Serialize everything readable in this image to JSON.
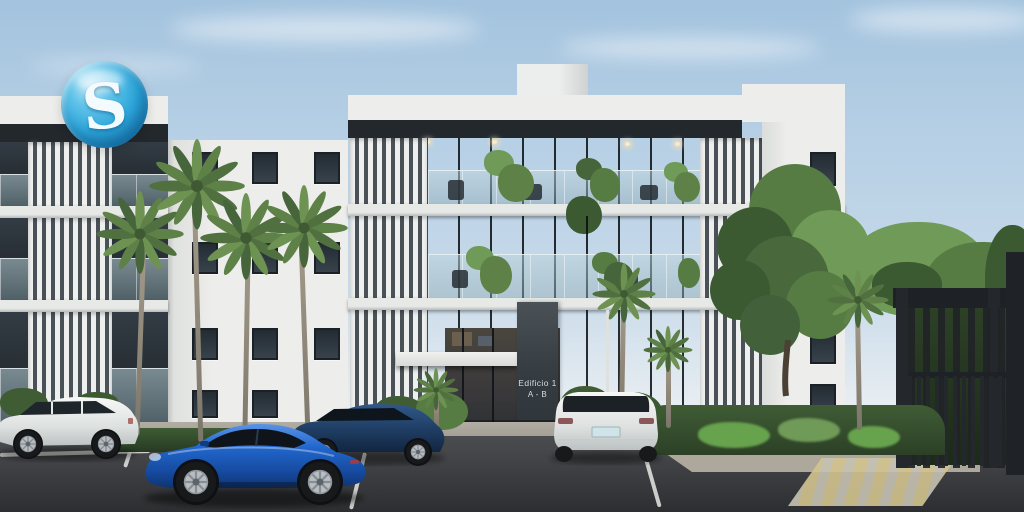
{
  "watermark": {
    "letter": "S",
    "icon": "glossy-blue-sphere-s-logo"
  },
  "signage": {
    "building_sign_line1": "Edificio 1",
    "building_sign_line2": "A - B"
  },
  "colors": {
    "sky_top": "#a3c3de",
    "sky_mid": "#c6d9e9",
    "sky_horizon": "#e9eef2",
    "cloud": "#ffffff",
    "facade_white": "#ededeb",
    "facade_shade": "#dadddb",
    "fascia_dark": "#23282d",
    "glass_dark": "#272e35",
    "balcony_glass": "#9db9c4",
    "louver_light": "#eef0f0",
    "louver_gap": "#4a5258",
    "slab_white": "#e7e9e7",
    "slab_shadow": "#b7bbba",
    "ceiling_light": "#ffe9c4",
    "palm_green": "#5e8148",
    "palm_green_dark": "#47653a",
    "palm_trunk": "#97907f",
    "tree_green": "#567c43",
    "tree_green_dark": "#3c5a31",
    "tree_green_light": "#6f9a57",
    "hedge_green": "#3f5c35",
    "fern_green": "#67a24d",
    "gate_dark": "#24272b",
    "gate_beam": "#1e2125",
    "asphalt": "#424447",
    "asphalt_dark": "#2c2e31",
    "pavement": "#ada89b",
    "curb": "#938e82",
    "line_white": "#e8e8e4",
    "crosswalk_yellow": "#d3c48e",
    "crosswalk_pale": "#c7c2b2",
    "car_white": "#f0f1ef",
    "car_blue": "#1f64c8",
    "car_blue_dark": "#123f8a",
    "car_navy": "#24456e",
    "tire_dark": "#17191b",
    "rim_silver": "#b8bdc2",
    "logo_blue": "#2da7dc",
    "logo_blue_dark": "#0f6fae",
    "logo_blue_light": "#bfe8f6",
    "logo_letter": "#f4fbfe",
    "sign_panel": "#3f474c",
    "sign_text": "#d6dadd"
  }
}
